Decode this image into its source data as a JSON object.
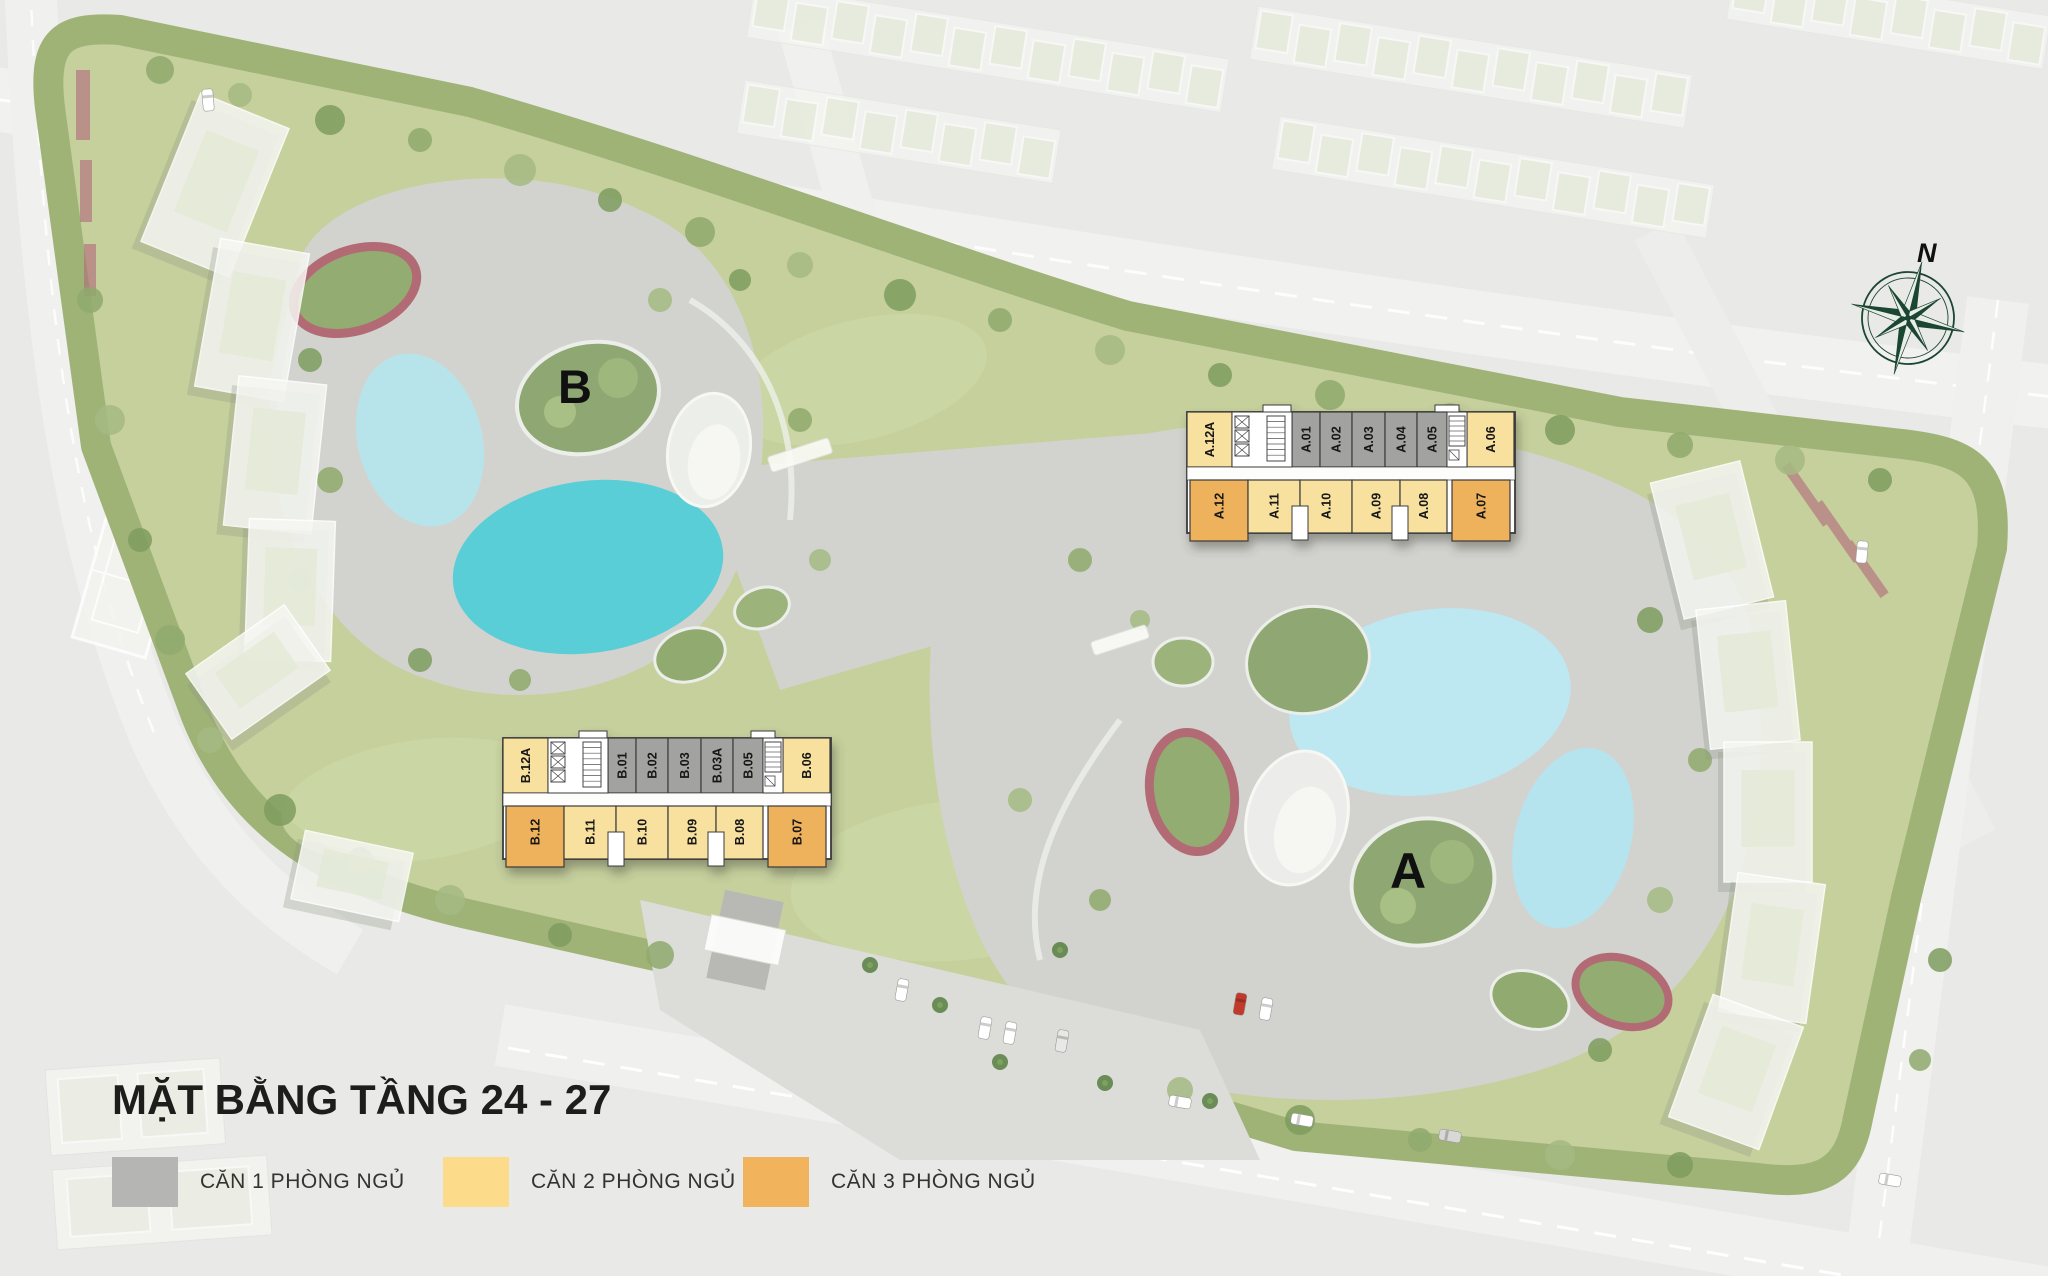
{
  "page": {
    "title": "MẶT BẰNG TẦNG 24 - 27"
  },
  "legend": {
    "items": [
      {
        "label": "CĂN 1 PHÒNG NGỦ",
        "color": "#b5b6b3",
        "type": "1br"
      },
      {
        "label": "CĂN 2 PHÒNG NGỦ",
        "color": "#fcdc8a",
        "type": "2br"
      },
      {
        "label": "CĂN 3 PHÒNG NGỦ",
        "color": "#f1b35b",
        "type": "3br"
      }
    ]
  },
  "compass": {
    "label": "N"
  },
  "unit_colors": {
    "1br": "#a2a2a1",
    "2br": "#f8e09e",
    "3br": "#eeb25d"
  },
  "blocks": [
    {
      "id": "A",
      "zone_label": "A",
      "top_row": [
        {
          "label": "A.12A",
          "type": "2br"
        },
        {
          "label": "A.01",
          "type": "1br"
        },
        {
          "label": "A.02",
          "type": "1br"
        },
        {
          "label": "A.03",
          "type": "1br"
        },
        {
          "label": "A.04",
          "type": "1br"
        },
        {
          "label": "A.05",
          "type": "1br"
        },
        {
          "label": "A.06",
          "type": "2br"
        }
      ],
      "bottom_row": [
        {
          "label": "A.12",
          "type": "3br"
        },
        {
          "label": "A.11",
          "type": "2br"
        },
        {
          "label": "A.10",
          "type": "2br"
        },
        {
          "label": "A.09",
          "type": "2br"
        },
        {
          "label": "A.08",
          "type": "2br"
        },
        {
          "label": "A.07",
          "type": "3br"
        }
      ]
    },
    {
      "id": "B",
      "zone_label": "B",
      "top_row": [
        {
          "label": "B.12A",
          "type": "2br"
        },
        {
          "label": "B.01",
          "type": "1br"
        },
        {
          "label": "B.02",
          "type": "1br"
        },
        {
          "label": "B.03",
          "type": "1br"
        },
        {
          "label": "B.03A",
          "type": "1br"
        },
        {
          "label": "B.05",
          "type": "1br"
        },
        {
          "label": "B.06",
          "type": "2br"
        }
      ],
      "bottom_row": [
        {
          "label": "B.12",
          "type": "3br"
        },
        {
          "label": "B.11",
          "type": "2br"
        },
        {
          "label": "B.10",
          "type": "2br"
        },
        {
          "label": "B.09",
          "type": "2br"
        },
        {
          "label": "B.08",
          "type": "2br"
        },
        {
          "label": "B.07",
          "type": "3br"
        }
      ]
    }
  ]
}
